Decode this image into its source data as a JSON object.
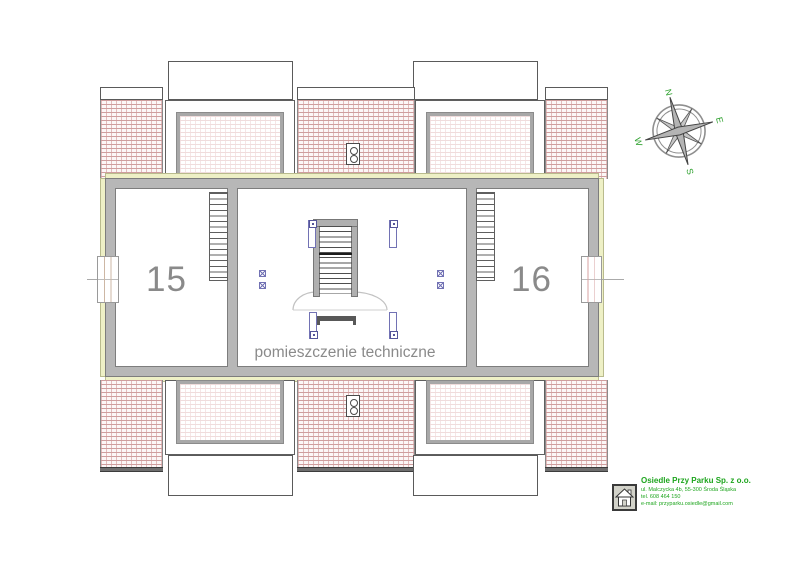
{
  "plan": {
    "unit_left_number": "15",
    "unit_right_number": "16",
    "technical_room_label": "pomieszczenie techniczne"
  },
  "compass": {
    "north": "N",
    "east": "E",
    "south": "S",
    "west": "W"
  },
  "company": {
    "name": "Osiedle Przy Parku Sp. z o.o.",
    "address": "ul. Malczycka 4b,   55-300 Środa Śląska",
    "phone": "tel. 608 464 150",
    "email": "e-mail: przyparku.osiedle@gmail.com"
  },
  "colors": {
    "wall": "#b7b7b7",
    "wall_edge": "#7d7d7d",
    "insulation": "#eef0c6",
    "roof_hatch": "#cf9e9e",
    "symbol_blue": "#7272b4",
    "label_gray": "#8a8a8a",
    "brand_green": "#1ea51e"
  }
}
